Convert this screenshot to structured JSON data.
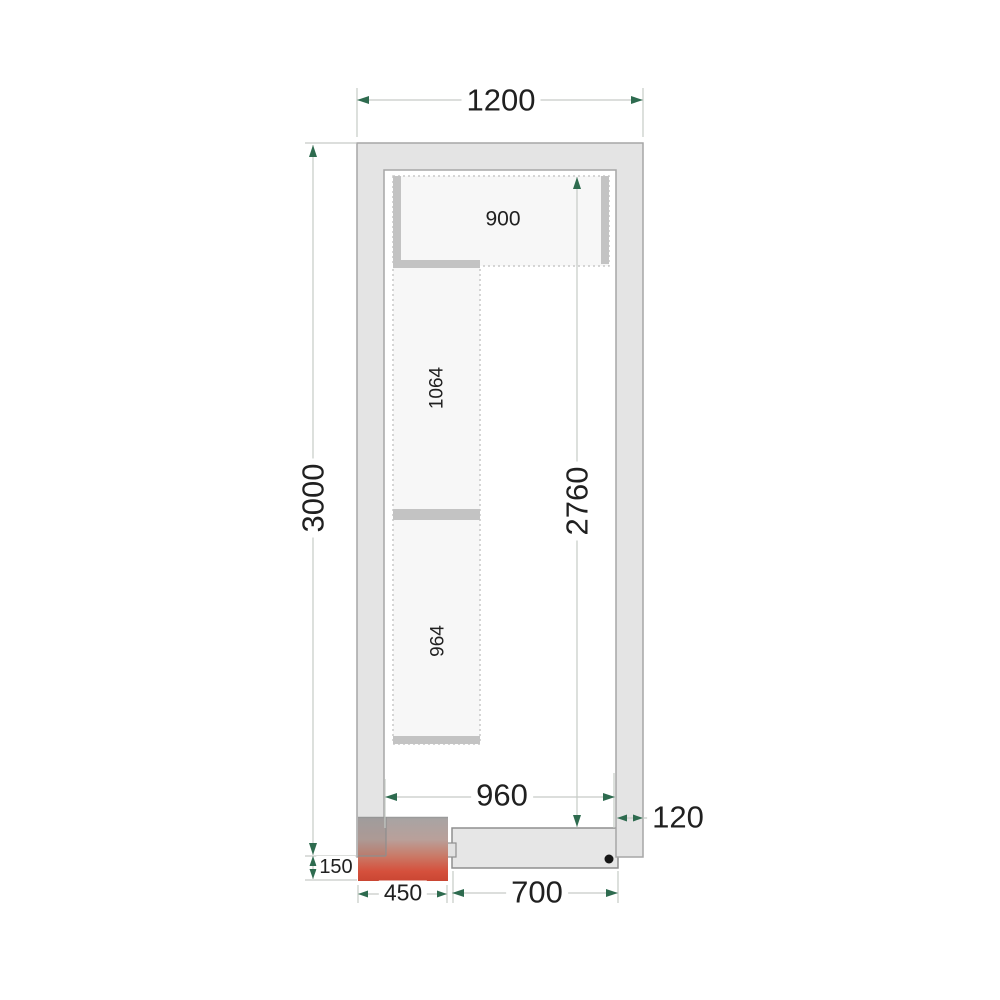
{
  "diagram": {
    "type": "cold-room-floor-plan-top-view",
    "dimension_labels": {
      "outer_width": "1200",
      "outer_length": "3000",
      "inner_length": "2760",
      "inner_width": "960",
      "wall_thickness": "120",
      "shelf_top_width": "900",
      "shelf_left_upper_length": "1064",
      "shelf_left_lower_length": "964",
      "corner_unit_width": "450",
      "corner_unit_protrusion": "150",
      "door_width": "700"
    },
    "colors": {
      "wall_fill": "#e4e4e4",
      "wall_stroke": "#a6a6a6",
      "shelf_fill": "#f7f7f7",
      "shelf_dotted_border": "#c9c9c9",
      "shelf_support_bar": "#c3c3c3",
      "dimension_line": "#c6cbc6",
      "dimension_arrow": "#2e6b4f",
      "heater_gradient_top": "#a7a4a4",
      "heater_gradient_bottom": "#ca4633",
      "door_fill": "#e6e6e6",
      "hinge_dot": "#161616",
      "label_text": "#202020"
    }
  }
}
